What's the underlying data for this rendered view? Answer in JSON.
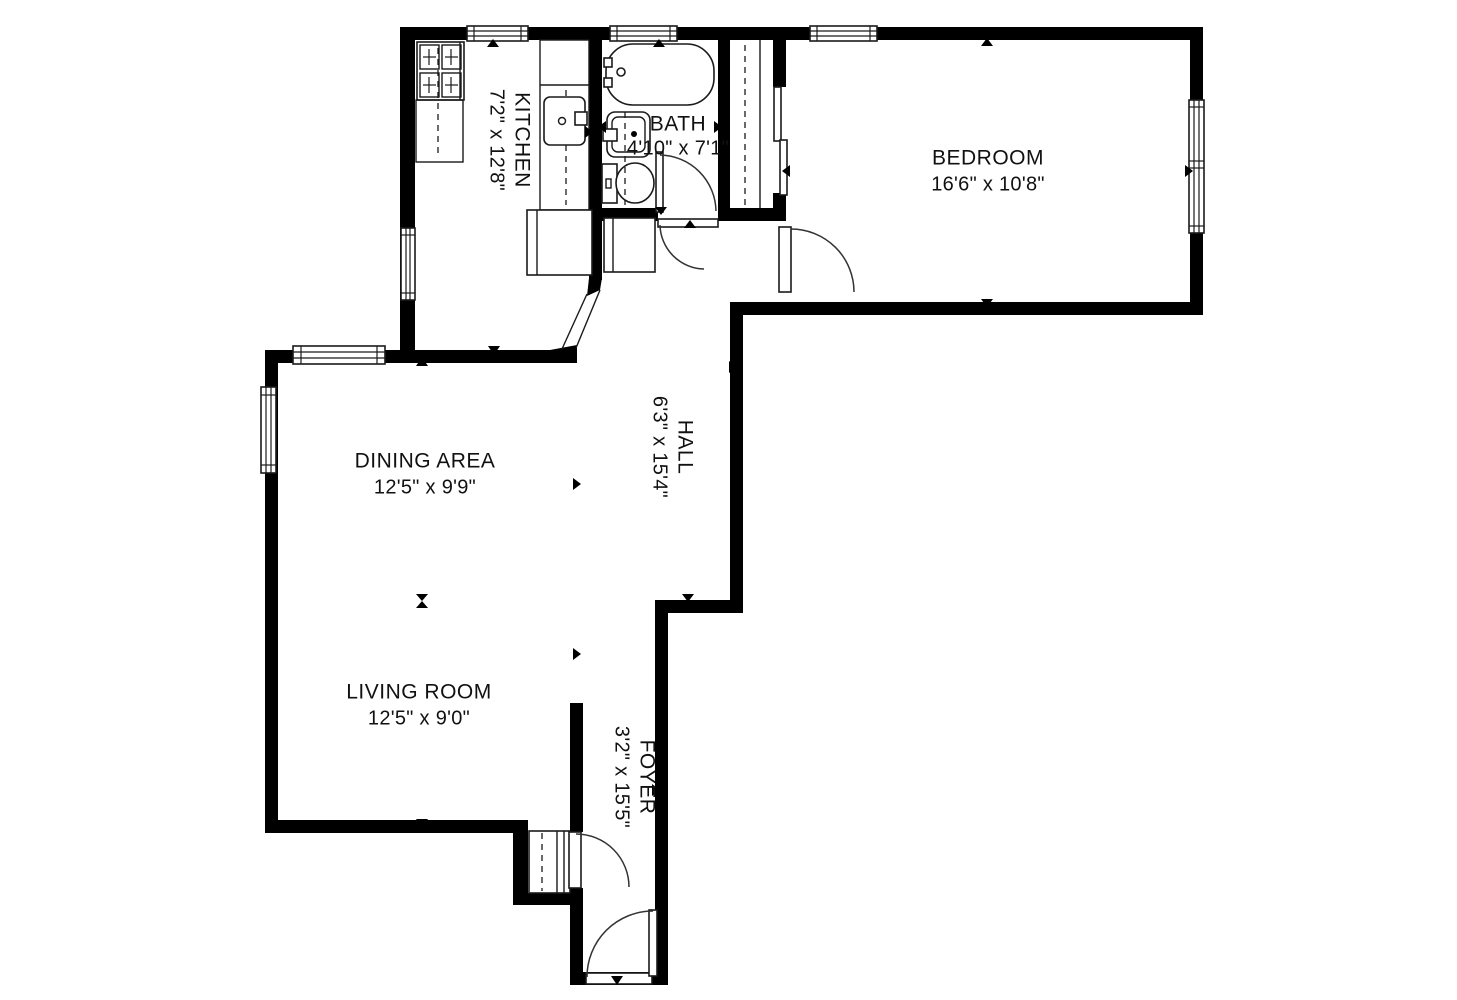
{
  "floorplan": {
    "type": "apartment-floor-plan",
    "colors": {
      "wall": "#000000",
      "background": "#ffffff",
      "text": "#111111"
    },
    "rooms": [
      {
        "id": "kitchen",
        "name": "KITCHEN",
        "dimensions": "7'2\" x 12'8\"",
        "label_rotation": "vertical"
      },
      {
        "id": "bath",
        "name": "BATH",
        "dimensions": "4'10\" x 7'1\"",
        "label_rotation": "horizontal"
      },
      {
        "id": "bedroom",
        "name": "BEDROOM",
        "dimensions": "16'6\" x 10'8\"",
        "label_rotation": "horizontal"
      },
      {
        "id": "dining",
        "name": "DINING AREA",
        "dimensions": "12'5\" x 9'9\"",
        "label_rotation": "horizontal"
      },
      {
        "id": "hall",
        "name": "HALL",
        "dimensions": "6'3\" x 15'4\"",
        "label_rotation": "vertical"
      },
      {
        "id": "living",
        "name": "LIVING ROOM",
        "dimensions": "12'5\" x 9'0\"",
        "label_rotation": "horizontal"
      },
      {
        "id": "foyer",
        "name": "FOYER",
        "dimensions": "3'2\" x 15'5\"",
        "label_rotation": "vertical"
      }
    ],
    "fixtures": [
      "stove-icon",
      "kitchen-counter",
      "kitchen-sink-icon",
      "bathtub-icon",
      "bathroom-sink-icon",
      "toilet-icon",
      "bedroom-closet",
      "hall-closet",
      "foyer-closet"
    ],
    "features": [
      "7 windows",
      "5 swing doors",
      "sliding closet doors",
      "angled kitchen opening",
      "direction markers"
    ]
  }
}
